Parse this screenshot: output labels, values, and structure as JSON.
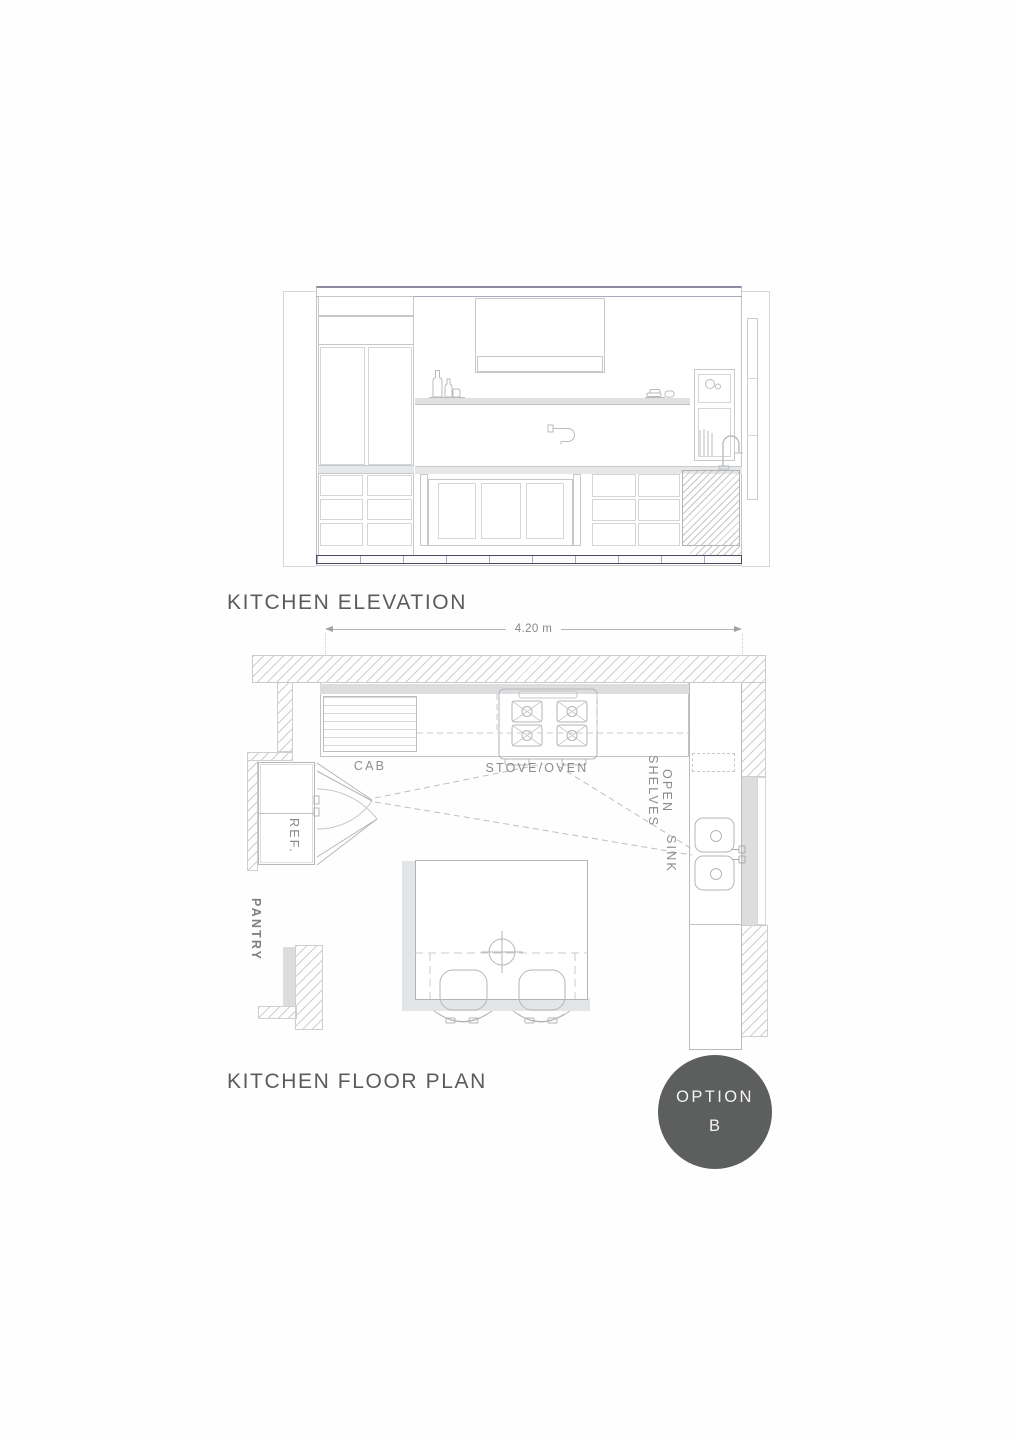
{
  "elevation": {
    "title": "KITCHEN ELEVATION"
  },
  "floor_plan": {
    "title": "KITCHEN FLOOR PLAN",
    "dimension_label": "4.20 m",
    "labels": {
      "cab": "CAB",
      "stove_oven": "STOVE/OVEN",
      "open": "OPEN",
      "shelves": "SHELVES",
      "sink": "SINK",
      "ref": "REF.",
      "pantry": "PANTRY"
    }
  },
  "option_badge": {
    "line1": "OPTION",
    "line2": "B",
    "background": "#5d5e5e",
    "text_color": "#f4f4f4"
  },
  "colors": {
    "drawing_line": "#c6c8ca",
    "dark_base_line": "#4a4a63",
    "wall_hatch": "#cdcfd1",
    "title_text": "#595c5f",
    "label_text": "#8a8c8f",
    "shadow_fill": "#e4e5e6"
  }
}
